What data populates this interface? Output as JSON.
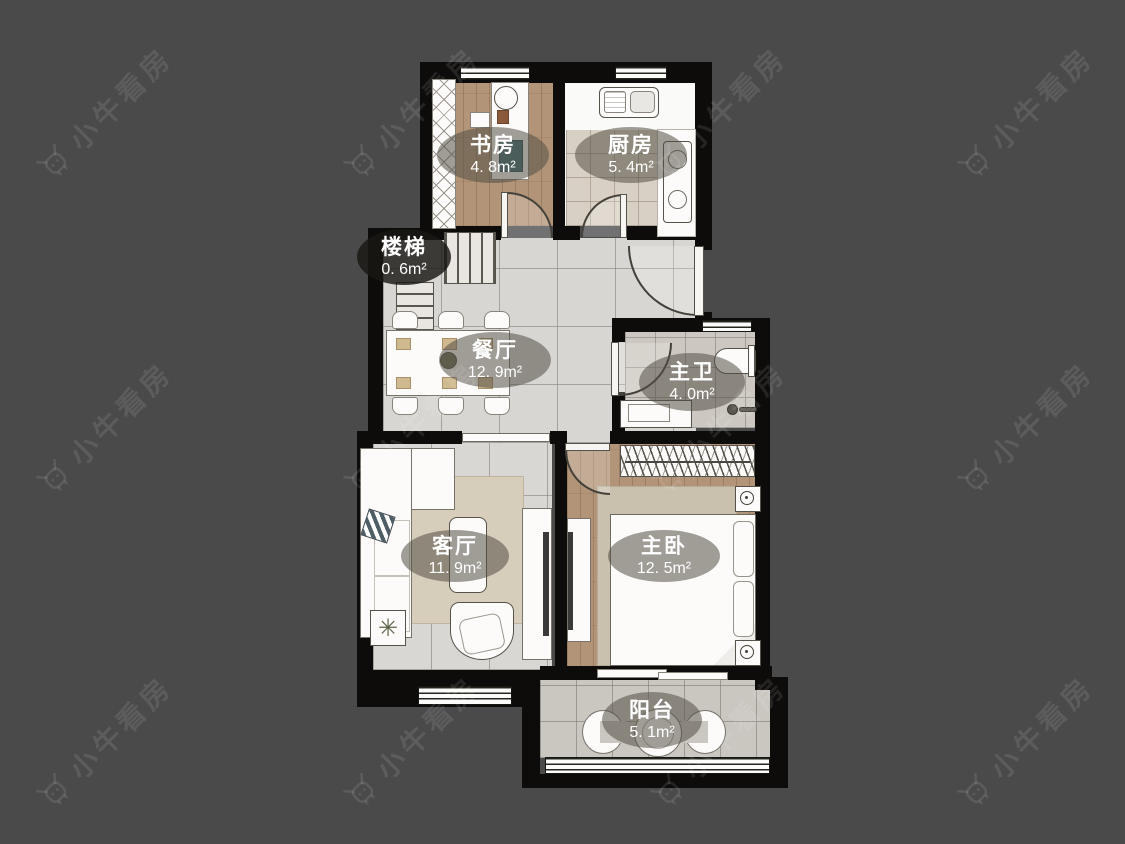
{
  "image": {
    "type": "residential floor plan",
    "width_px": 1125,
    "height_px": 844
  },
  "watermark": {
    "brand": "小牛看房",
    "positions": [
      {
        "x": 105,
        "y": 113
      },
      {
        "x": 412,
        "y": 113
      },
      {
        "x": 719,
        "y": 113
      },
      {
        "x": 1026,
        "y": 113
      },
      {
        "x": 105,
        "y": 428
      },
      {
        "x": 412,
        "y": 428
      },
      {
        "x": 719,
        "y": 428
      },
      {
        "x": 1026,
        "y": 428
      },
      {
        "x": 105,
        "y": 742
      },
      {
        "x": 412,
        "y": 742
      },
      {
        "x": 719,
        "y": 742
      },
      {
        "x": 1026,
        "y": 742
      }
    ]
  },
  "rooms": [
    {
      "id": "study",
      "name": "书房",
      "area": "4. 8m²"
    },
    {
      "id": "kitchen",
      "name": "厨房",
      "area": "5. 4m²"
    },
    {
      "id": "stairs",
      "name": "楼梯",
      "area": "0. 6m²"
    },
    {
      "id": "dining",
      "name": "餐厅",
      "area": "12. 9m²"
    },
    {
      "id": "bath",
      "name": "主卫",
      "area": "4. 0m²"
    },
    {
      "id": "living",
      "name": "客厅",
      "area": "11. 9m²"
    },
    {
      "id": "bedroom",
      "name": "主卧",
      "area": "12. 5m²"
    },
    {
      "id": "balcony",
      "name": "阳台",
      "area": "5. 1m²"
    }
  ],
  "colors": {
    "background": "#4a4a4a",
    "wall": "#0d0c0a",
    "wood-floor": "#b29478",
    "tile-floor": "#d8d6d2",
    "bath-floor": "#ccc8c1",
    "balcony-floor": "#cac7c1",
    "kitchen-tile": "#d8d0c4",
    "rug-living": "#d7cdbb",
    "rug-bedroom": "#c9c0ae",
    "pill": "rgba(84,78,70,0.55)",
    "pill-dark": "rgba(26,23,20,0.82)",
    "watermark": "rgba(255,255,255,0.10)"
  }
}
